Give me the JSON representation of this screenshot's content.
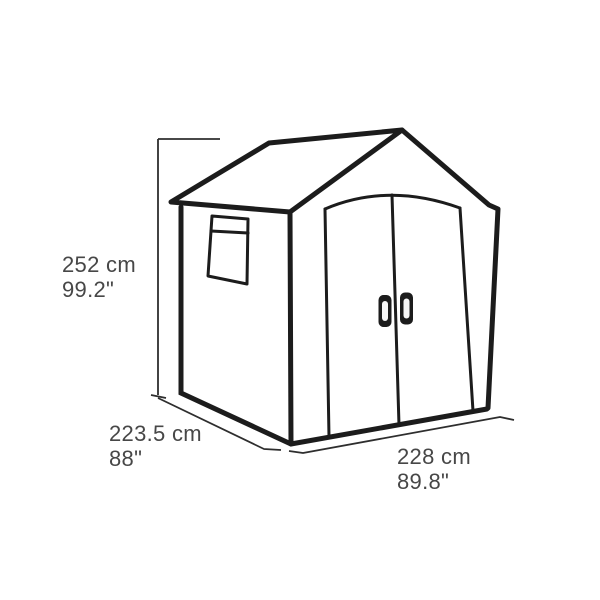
{
  "diagram_type": "product-dimension-line-drawing",
  "subject": "garden-shed",
  "dimensions": {
    "height": {
      "cm": "252 cm",
      "inches": "99.2\""
    },
    "depth": {
      "cm": "223.5 cm",
      "inches": "88\""
    },
    "width": {
      "cm": "228 cm",
      "inches": "89.8\""
    }
  },
  "colors": {
    "background": "#ffffff",
    "line": "#1c1c1c",
    "dimension_line": "#2e2e2e",
    "text": "#474747"
  }
}
